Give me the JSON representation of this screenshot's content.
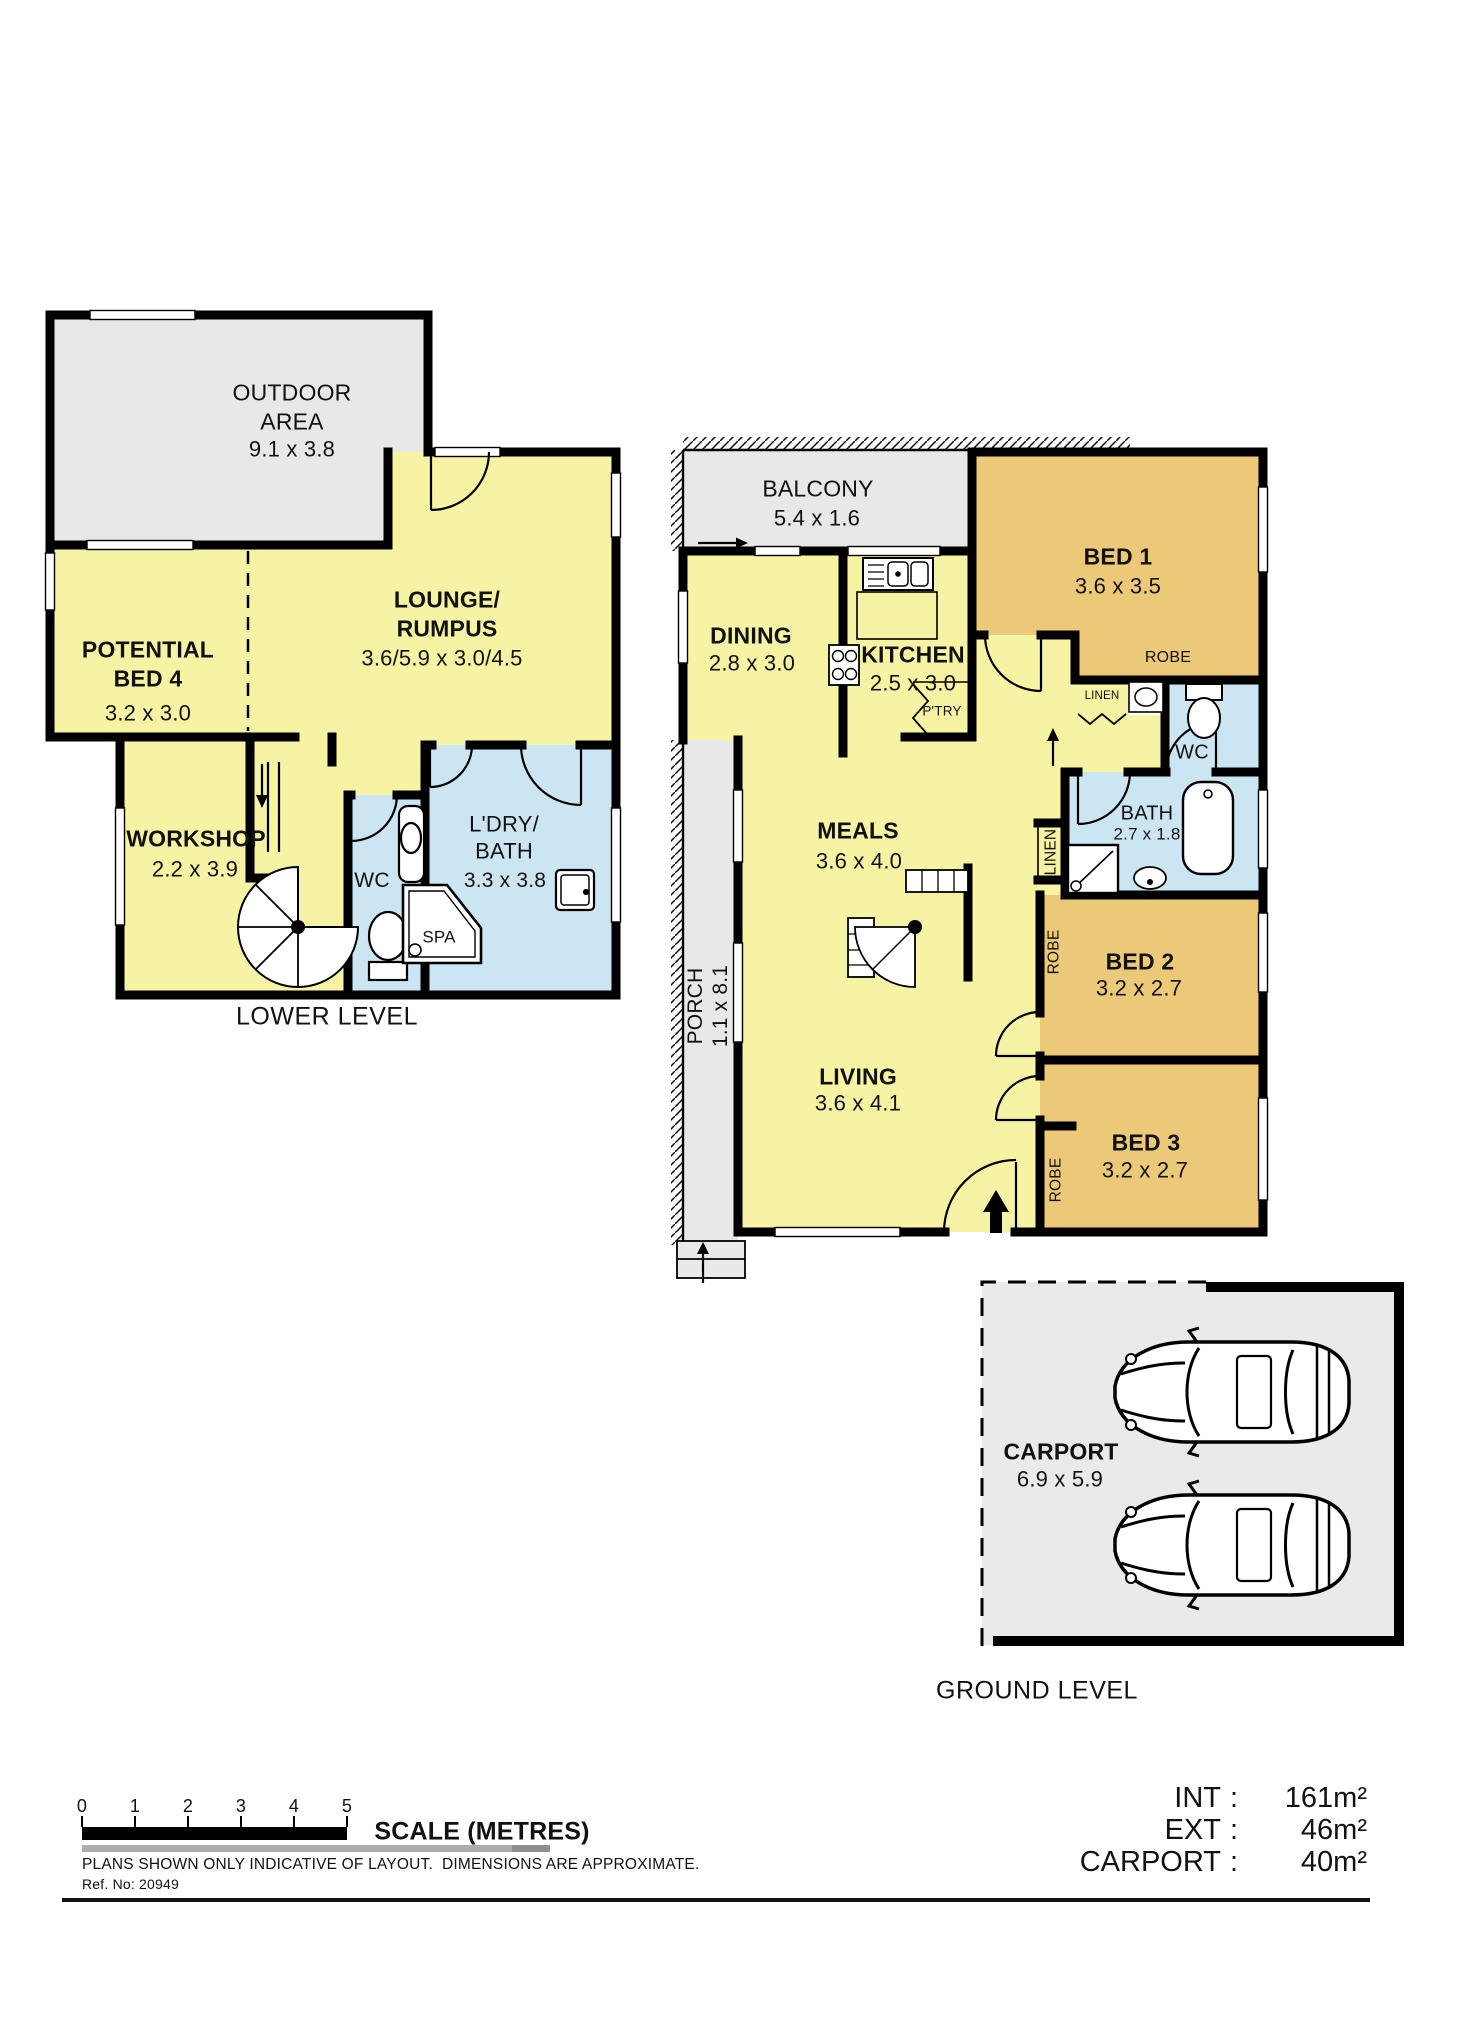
{
  "palette": {
    "yellow": "#F6F3A4",
    "tan": "#ECC979",
    "blue": "#CBE5F2",
    "gray": "#E8E8E8",
    "carport_gray": "#EAEAEA",
    "wall": "#000000"
  },
  "lower": {
    "caption": "LOWER LEVEL",
    "outdoor": {
      "name": "OUTDOOR\nAREA",
      "dims": "9.1 x 3.8"
    },
    "bed4": {
      "name": "POTENTIAL\nBED 4",
      "dims": "3.2 x 3.0"
    },
    "lounge": {
      "name": "LOUNGE/\nRUMPUS",
      "dims": "3.6/5.9 x 3.0/4.5"
    },
    "workshop": {
      "name": "WORKSHOP",
      "dims": "2.2 x 3.9"
    },
    "wc": {
      "name": "WC"
    },
    "laundry": {
      "name": "L'DRY/\nBATH",
      "dims": "3.3 x 3.8"
    },
    "spa": {
      "name": "SPA"
    }
  },
  "ground": {
    "caption": "GROUND LEVEL",
    "balcony": {
      "name": "BALCONY",
      "dims": "5.4 x 1.6"
    },
    "dining": {
      "name": "DINING",
      "dims": "2.8 x 3.0"
    },
    "kitchen": {
      "name": "KITCHEN",
      "dims": "2.5 x 3.0"
    },
    "pantry": {
      "name": "P'TRY"
    },
    "bed1": {
      "name": "BED 1",
      "d": "3.6 x 3.5"
    },
    "robe1": {
      "name": "ROBE"
    },
    "linen1": {
      "name": "LINEN"
    },
    "wc": {
      "name": "WC"
    },
    "bath": {
      "name": "BATH",
      "dims": "2.7 x 1.8"
    },
    "linen2": {
      "name": "LINEN"
    },
    "meals": {
      "name": "MEALS",
      "dims": "3.6 x 4.0"
    },
    "robe2": {
      "name": "ROBE"
    },
    "bed2": {
      "name": "BED 2",
      "dims": "3.2 x 2.7"
    },
    "bed3": {
      "name": "BED 3",
      "dims": "3.2 x 2.7"
    },
    "robe3": {
      "name": "ROBE"
    },
    "porch": {
      "name": "PORCH",
      "dims": "1.1 x 8.1"
    },
    "living": {
      "name": "LIVING",
      "dims": "3.6 x 4.1"
    },
    "carport": {
      "name": "CARPORT",
      "dims": "6.9 x 5.9"
    }
  },
  "footer": {
    "scale_ticks": [
      "0",
      "1",
      "2",
      "3",
      "4",
      "5"
    ],
    "scale_label": "SCALE (METRES)",
    "disclaimer": "PLANS SHOWN ONLY INDICATIVE OF LAYOUT.  DIMENSIONS ARE APPROXIMATE.",
    "ref": "Ref. No: 20949",
    "sep": ":",
    "areas": [
      {
        "label": "INT",
        "value": "161m²"
      },
      {
        "label": "EXT",
        "value": "46m²"
      },
      {
        "label": "CARPORT",
        "value": "40m²"
      }
    ]
  }
}
